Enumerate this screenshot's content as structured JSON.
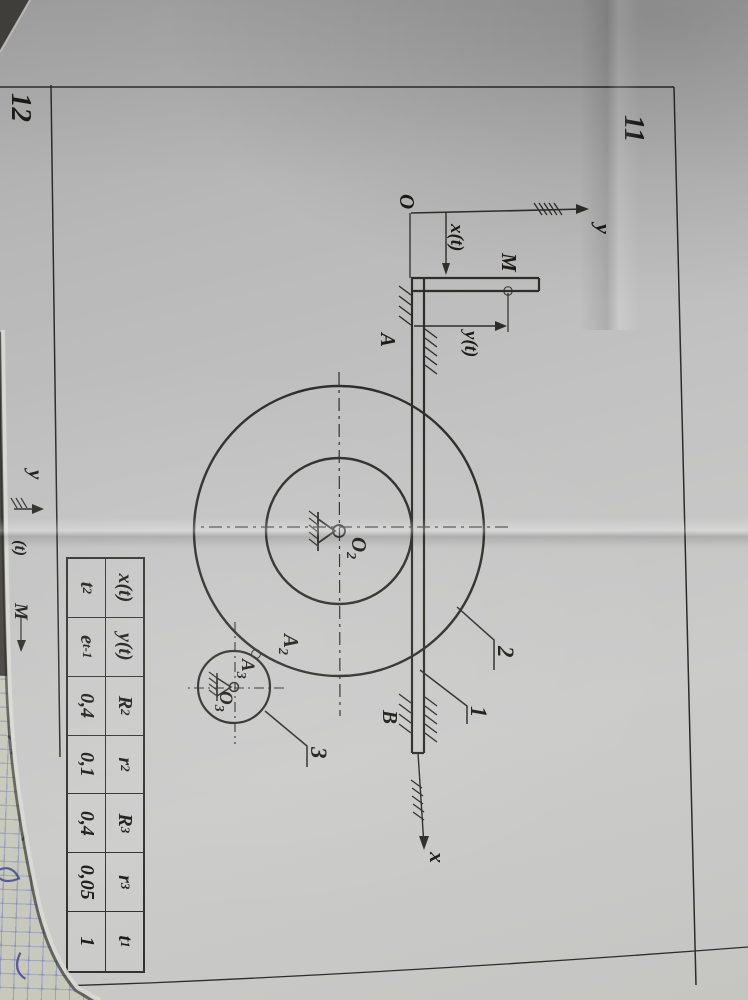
{
  "figure": {
    "number": "11",
    "next_number": "12"
  },
  "diagram": {
    "origin": "O",
    "axis_y": "y",
    "axis_x": "x",
    "dim_x": "x(t)",
    "dim_y": "y(t)",
    "point_m": "M",
    "guide_a": "A",
    "guide_b": "B",
    "o2": {
      "base": "O",
      "sub": "2"
    },
    "a2": {
      "base": "A",
      "sub": "2"
    },
    "a3": {
      "base": "A",
      "sub": "3"
    },
    "o3": {
      "base": "O",
      "sub": "3"
    },
    "part_rack": "1",
    "part_gear2": "2",
    "part_gear3": "3"
  },
  "figure12": {
    "axis_y": "y",
    "fragment_m": "M",
    "fragment_t": "(t)"
  },
  "table": {
    "headers": [
      {
        "base": "x(t)"
      },
      {
        "base": "y(t)"
      },
      {
        "base": "R",
        "sub": "2"
      },
      {
        "base": "r",
        "sub": "2"
      },
      {
        "base": "R",
        "sub": "3"
      },
      {
        "base": "r",
        "sub": "3"
      },
      {
        "base": "t",
        "sub": "1"
      }
    ],
    "values": [
      {
        "base": "t",
        "sup": "2"
      },
      {
        "base": "e",
        "sup": "t-1"
      },
      {
        "base": "0,4"
      },
      {
        "base": "0,1"
      },
      {
        "base": "0,4"
      },
      {
        "base": "0,05"
      },
      {
        "base": "1"
      }
    ]
  },
  "colors": {
    "paper": "#c2c2c2",
    "ink": "#2f2d2a",
    "notebook_paper": "#c6c9bb",
    "notebook_grid": "#6066be",
    "handwriting_ink": "#3b3e8e"
  }
}
